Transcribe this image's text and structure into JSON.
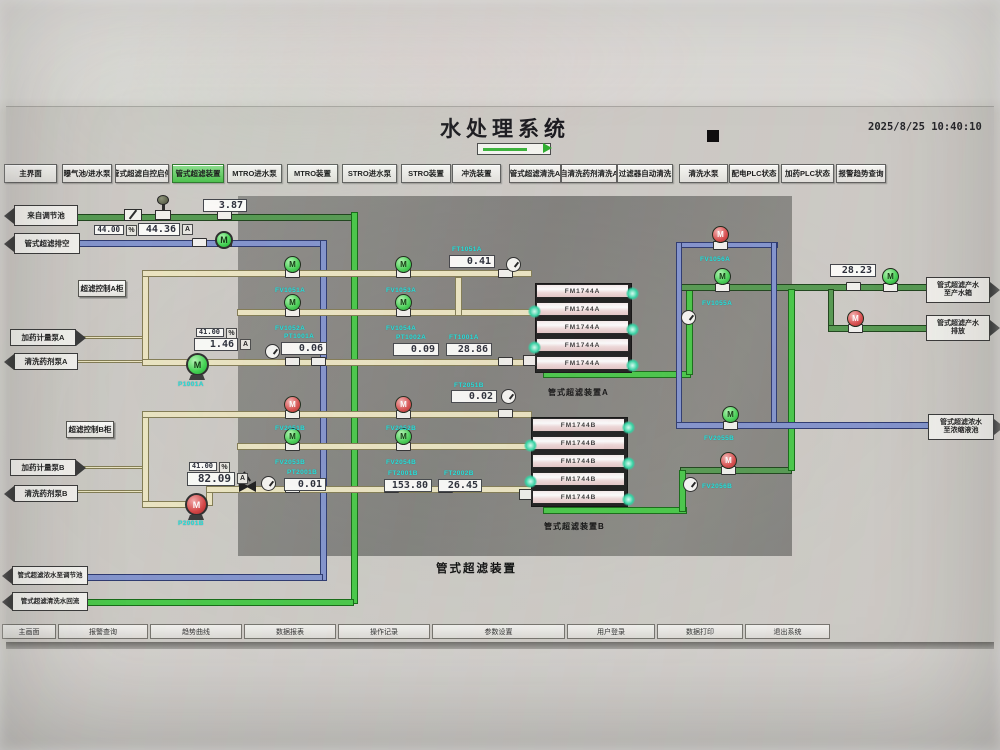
{
  "header": {
    "title": "水处理系统",
    "datetime": "2025/8/25  10:40:10"
  },
  "colors": {
    "active_tab": "#4cc24c",
    "pipe_green": "#569a52",
    "pipe_bright_green": "#49c849",
    "pipe_blue": "#8494cd",
    "pipe_yellow": "#ece5c2",
    "valve_open": "#46d054",
    "valve_closed": "#d94d4d",
    "instrument_tag": "#23e2dd"
  },
  "tabs": [
    {
      "label": "主界面",
      "x": 4,
      "w": 53,
      "active": false
    },
    {
      "label": "曝气池/进水泵",
      "x": 62,
      "w": 50,
      "active": false
    },
    {
      "label": "管式超滤自控启停",
      "x": 115,
      "w": 54,
      "active": false
    },
    {
      "label": "管式超滤装置",
      "x": 172,
      "w": 52,
      "active": true
    },
    {
      "label": "MTRO进水泵",
      "x": 227,
      "w": 55,
      "active": false
    },
    {
      "label": "MTRO装置",
      "x": 287,
      "w": 51,
      "active": false
    },
    {
      "label": "STRO进水泵",
      "x": 342,
      "w": 55,
      "active": false
    },
    {
      "label": "STRO装置",
      "x": 401,
      "w": 50,
      "active": false
    },
    {
      "label": "冲洗装置",
      "x": 452,
      "w": 49,
      "active": false
    },
    {
      "label": "管式超滤清洗A",
      "x": 509,
      "w": 52,
      "active": false
    },
    {
      "label": "自清洗药剂清洗A",
      "x": 561,
      "w": 56,
      "active": false
    },
    {
      "label": "过滤器自动清洗",
      "x": 617,
      "w": 56,
      "active": false
    },
    {
      "label": "清洗水泵",
      "x": 679,
      "w": 49,
      "active": false
    },
    {
      "label": "配电PLC状态",
      "x": 729,
      "w": 50,
      "active": false
    },
    {
      "label": "加药PLC状态",
      "x": 781,
      "w": 53,
      "active": false
    },
    {
      "label": "报警趋势查询",
      "x": 836,
      "w": 50,
      "active": false
    }
  ],
  "footer_buttons": [
    {
      "label": "主画面",
      "x": 0,
      "w": 54
    },
    {
      "label": "报警查询",
      "x": 56,
      "w": 90
    },
    {
      "label": "趋势曲线",
      "x": 148,
      "w": 92
    },
    {
      "label": "数据报表",
      "x": 242,
      "w": 92
    },
    {
      "label": "操作记录",
      "x": 336,
      "w": 92
    },
    {
      "label": "参数设置",
      "x": 430,
      "w": 133
    },
    {
      "label": "用户登录",
      "x": 565,
      "w": 88
    },
    {
      "label": "数据打印",
      "x": 655,
      "w": 86
    },
    {
      "label": "退出系统",
      "x": 743,
      "w": 85
    }
  ],
  "diagram": {
    "center_title": "管式超滤装置",
    "cabinets": [
      {
        "label": "超滤控制A柜",
        "x": 78,
        "y": 280,
        "w": 48,
        "h": 17
      },
      {
        "label": "超滤控制B柜",
        "x": 66,
        "y": 421,
        "w": 48,
        "h": 17
      }
    ],
    "pipes": [
      {
        "x": 77,
        "y": 214,
        "w": 276,
        "h": 7,
        "c": "green"
      },
      {
        "x": 351,
        "y": 212,
        "w": 7,
        "h": 392,
        "c": "bgreen"
      },
      {
        "x": 80,
        "y": 599,
        "w": 274,
        "h": 7,
        "c": "bgreen"
      },
      {
        "x": 543,
        "y": 371,
        "w": 148,
        "h": 7,
        "c": "bgreen"
      },
      {
        "x": 686,
        "y": 289,
        "w": 7,
        "h": 86,
        "c": "bgreen"
      },
      {
        "x": 679,
        "y": 284,
        "w": 260,
        "h": 7,
        "c": "green"
      },
      {
        "x": 828,
        "y": 289,
        "w": 6,
        "h": 40,
        "c": "green"
      },
      {
        "x": 828,
        "y": 325,
        "w": 110,
        "h": 7,
        "c": "green"
      },
      {
        "x": 680,
        "y": 467,
        "w": 112,
        "h": 7,
        "c": "green"
      },
      {
        "x": 788,
        "y": 289,
        "w": 7,
        "h": 182,
        "c": "bgreen"
      },
      {
        "x": 543,
        "y": 507,
        "w": 144,
        "h": 7,
        "c": "bgreen"
      },
      {
        "x": 679,
        "y": 470,
        "w": 7,
        "h": 42,
        "c": "bgreen"
      },
      {
        "x": 77,
        "y": 240,
        "w": 250,
        "h": 7,
        "c": "blue"
      },
      {
        "x": 320,
        "y": 240,
        "w": 7,
        "h": 341,
        "c": "blue"
      },
      {
        "x": 85,
        "y": 574,
        "w": 238,
        "h": 7,
        "c": "blue"
      },
      {
        "x": 679,
        "y": 242,
        "w": 99,
        "h": 6,
        "c": "blue"
      },
      {
        "x": 676,
        "y": 242,
        "w": 6,
        "h": 186,
        "c": "blue"
      },
      {
        "x": 771,
        "y": 242,
        "w": 6,
        "h": 186,
        "c": "blue"
      },
      {
        "x": 676,
        "y": 422,
        "w": 262,
        "h": 7,
        "c": "blue"
      },
      {
        "x": 142,
        "y": 270,
        "w": 7,
        "h": 95,
        "c": "yellow"
      },
      {
        "x": 142,
        "y": 270,
        "w": 390,
        "h": 7,
        "c": "yellow"
      },
      {
        "x": 237,
        "y": 309,
        "w": 295,
        "h": 7,
        "c": "yellow"
      },
      {
        "x": 142,
        "y": 359,
        "w": 390,
        "h": 7,
        "c": "yellow"
      },
      {
        "x": 77,
        "y": 336,
        "w": 66,
        "h": 3,
        "c": "yellow"
      },
      {
        "x": 77,
        "y": 360,
        "w": 66,
        "h": 3,
        "c": "yellow"
      },
      {
        "x": 455,
        "y": 277,
        "w": 7,
        "h": 39,
        "c": "yellow"
      },
      {
        "x": 142,
        "y": 411,
        "w": 7,
        "h": 95,
        "c": "yellow"
      },
      {
        "x": 142,
        "y": 411,
        "w": 390,
        "h": 7,
        "c": "yellow"
      },
      {
        "x": 237,
        "y": 443,
        "w": 295,
        "h": 7,
        "c": "yellow"
      },
      {
        "x": 142,
        "y": 501,
        "w": 60,
        "h": 7,
        "c": "yellow"
      },
      {
        "x": 206,
        "y": 486,
        "w": 7,
        "h": 20,
        "c": "yellow"
      },
      {
        "x": 206,
        "y": 486,
        "w": 326,
        "h": 7,
        "c": "yellow"
      },
      {
        "x": 77,
        "y": 466,
        "w": 66,
        "h": 3,
        "c": "yellow"
      },
      {
        "x": 77,
        "y": 490,
        "w": 66,
        "h": 3,
        "c": "yellow"
      }
    ],
    "valves": [
      {
        "x": 284,
        "y": 256,
        "s": "o",
        "py": 270,
        "name": "valve-FV1051A"
      },
      {
        "x": 395,
        "y": 256,
        "s": "o",
        "py": 270,
        "name": "valve-FV1053A"
      },
      {
        "x": 284,
        "y": 294,
        "s": "o",
        "py": 309,
        "name": "valve-FV1052A"
      },
      {
        "x": 395,
        "y": 294,
        "s": "o",
        "py": 309,
        "name": "valve-FV1054A"
      },
      {
        "x": 284,
        "y": 396,
        "s": "c",
        "py": 411,
        "name": "valve-FV2051B"
      },
      {
        "x": 395,
        "y": 396,
        "s": "c",
        "py": 411,
        "name": "valve-FV2052B"
      },
      {
        "x": 284,
        "y": 428,
        "s": "o",
        "py": 443,
        "name": "valve-FV2053B"
      },
      {
        "x": 395,
        "y": 428,
        "s": "o",
        "py": 443,
        "name": "valve-FV2054B"
      },
      {
        "x": 714,
        "y": 268,
        "s": "o",
        "py": 284,
        "name": "valve-FV1055A"
      },
      {
        "x": 882,
        "y": 268,
        "s": "o",
        "py": 284,
        "name": "valve-product-outlet"
      },
      {
        "x": 712,
        "y": 226,
        "s": "c",
        "py": 242,
        "name": "valve-FV1056A"
      },
      {
        "x": 847,
        "y": 310,
        "s": "c",
        "py": 325,
        "name": "valve-drain-outlet"
      },
      {
        "x": 722,
        "y": 406,
        "s": "o",
        "py": 422,
        "name": "valve-FV2055B"
      },
      {
        "x": 720,
        "y": 452,
        "s": "c",
        "py": 467,
        "name": "valve-FV2056B"
      }
    ],
    "fittings": [
      {
        "x": 498,
        "y": 269
      },
      {
        "x": 285,
        "y": 357
      },
      {
        "x": 311,
        "y": 357
      },
      {
        "x": 498,
        "y": 357
      },
      {
        "x": 498,
        "y": 409
      },
      {
        "x": 285,
        "y": 484
      },
      {
        "x": 384,
        "y": 484
      },
      {
        "x": 438,
        "y": 484
      },
      {
        "x": 846,
        "y": 282
      },
      {
        "x": 192,
        "y": 238
      },
      {
        "x": 217,
        "y": 238
      },
      {
        "x": 217,
        "y": 211
      }
    ],
    "gauges": [
      {
        "x": 506,
        "y": 257
      },
      {
        "x": 265,
        "y": 344
      },
      {
        "x": 501,
        "y": 389
      },
      {
        "x": 261,
        "y": 476
      },
      {
        "x": 681,
        "y": 310
      },
      {
        "x": 683,
        "y": 477
      }
    ],
    "pumps": [
      {
        "x": 215,
        "y": 231,
        "size": 18,
        "s": "run",
        "feet": false,
        "label": "M",
        "name": "pump-feed-booster"
      },
      {
        "x": 186,
        "y": 353,
        "size": 23,
        "s": "run",
        "feet": true,
        "label": "M",
        "name": "pump-P1001A"
      },
      {
        "x": 185,
        "y": 493,
        "size": 23,
        "s": "stop",
        "feet": true,
        "label": "M",
        "name": "pump-P2001B"
      }
    ],
    "values": [
      {
        "x": 203,
        "y": 199,
        "w": 44,
        "h": 13,
        "t": "3.87",
        "fs": 10
      },
      {
        "x": 94,
        "y": 225,
        "w": 30,
        "h": 10,
        "t": "44.00",
        "fs": 7.5
      },
      {
        "x": 138,
        "y": 223,
        "w": 42,
        "h": 13,
        "t": "44.36",
        "fs": 10
      },
      {
        "x": 449,
        "y": 255,
        "w": 46,
        "h": 13,
        "t": "0.41",
        "fs": 10
      },
      {
        "x": 281,
        "y": 342,
        "w": 46,
        "h": 13,
        "t": "0.06",
        "fs": 10
      },
      {
        "x": 393,
        "y": 343,
        "w": 46,
        "h": 13,
        "t": "0.09",
        "fs": 10
      },
      {
        "x": 446,
        "y": 343,
        "w": 46,
        "h": 13,
        "t": "28.86",
        "fs": 10
      },
      {
        "x": 830,
        "y": 264,
        "w": 46,
        "h": 13,
        "t": "28.23",
        "fs": 10
      },
      {
        "x": 451,
        "y": 390,
        "w": 46,
        "h": 13,
        "t": "0.02",
        "fs": 10
      },
      {
        "x": 196,
        "y": 328,
        "w": 28,
        "h": 9,
        "t": "41.00",
        "fs": 7
      },
      {
        "x": 194,
        "y": 338,
        "w": 44,
        "h": 13,
        "t": "1.46",
        "fs": 10
      },
      {
        "x": 189,
        "y": 462,
        "w": 28,
        "h": 9,
        "t": "41.00",
        "fs": 7
      },
      {
        "x": 187,
        "y": 472,
        "w": 48,
        "h": 14,
        "t": "82.09",
        "fs": 11
      },
      {
        "x": 284,
        "y": 478,
        "w": 42,
        "h": 13,
        "t": "0.01",
        "fs": 10
      },
      {
        "x": 384,
        "y": 479,
        "w": 48,
        "h": 13,
        "t": "153.80",
        "fs": 10
      },
      {
        "x": 438,
        "y": 479,
        "w": 44,
        "h": 13,
        "t": "26.45",
        "fs": 10
      }
    ],
    "units": [
      {
        "x": 126,
        "y": 225,
        "t": "%"
      },
      {
        "x": 182,
        "y": 224,
        "t": "A"
      },
      {
        "x": 226,
        "y": 328,
        "t": "%"
      },
      {
        "x": 240,
        "y": 339,
        "t": "A"
      },
      {
        "x": 219,
        "y": 462,
        "t": "%"
      },
      {
        "x": 237,
        "y": 473,
        "t": "A"
      }
    ],
    "tags": [
      {
        "x": 452,
        "y": 246,
        "t": "FT1051A"
      },
      {
        "x": 284,
        "y": 333,
        "t": "PT1001A"
      },
      {
        "x": 396,
        "y": 334,
        "t": "PT1002A"
      },
      {
        "x": 449,
        "y": 334,
        "t": "FT1001A"
      },
      {
        "x": 454,
        "y": 382,
        "t": "FT2051B"
      },
      {
        "x": 287,
        "y": 469,
        "t": "PT2001B"
      },
      {
        "x": 388,
        "y": 470,
        "t": "FT2001B"
      },
      {
        "x": 444,
        "y": 470,
        "t": "FT2002B"
      },
      {
        "x": 275,
        "y": 287,
        "t": "FV1051A"
      },
      {
        "x": 386,
        "y": 287,
        "t": "FV1053A"
      },
      {
        "x": 275,
        "y": 325,
        "t": "FV1052A"
      },
      {
        "x": 386,
        "y": 325,
        "t": "FV1054A"
      },
      {
        "x": 275,
        "y": 425,
        "t": "FV2051B"
      },
      {
        "x": 386,
        "y": 425,
        "t": "FV2052B"
      },
      {
        "x": 275,
        "y": 459,
        "t": "FV2053B"
      },
      {
        "x": 386,
        "y": 459,
        "t": "FV2054B"
      },
      {
        "x": 700,
        "y": 256,
        "t": "FV1056A"
      },
      {
        "x": 702,
        "y": 300,
        "t": "FV1055A"
      },
      {
        "x": 704,
        "y": 435,
        "t": "FV2055B"
      },
      {
        "x": 702,
        "y": 483,
        "t": "FV2056B"
      },
      {
        "x": 178,
        "y": 381,
        "t": "P1001A"
      },
      {
        "x": 178,
        "y": 520,
        "t": "P2001B"
      }
    ],
    "banks": [
      {
        "x": 535,
        "y": 283,
        "w": 95,
        "h": 88,
        "modules": [
          "FM1744A",
          "FM1744A",
          "FM1744A",
          "FM1744A",
          "FM1744A"
        ],
        "dots": [
          {
            "x": 626,
            "y": 287
          },
          {
            "x": 626,
            "y": 323
          },
          {
            "x": 626,
            "y": 359
          },
          {
            "x": 528,
            "y": 305
          },
          {
            "x": 528,
            "y": 341
          }
        ],
        "cap": {
          "x": 523,
          "y": 355
        },
        "caption": {
          "x": 548,
          "y": 387,
          "t": "管式超滤装置A"
        }
      },
      {
        "x": 531,
        "y": 417,
        "w": 95,
        "h": 88,
        "modules": [
          "FM1744B",
          "FM1744B",
          "FM1744B",
          "FM1744B",
          "FM1744B"
        ],
        "dots": [
          {
            "x": 622,
            "y": 421
          },
          {
            "x": 622,
            "y": 457
          },
          {
            "x": 622,
            "y": 493
          },
          {
            "x": 524,
            "y": 439
          },
          {
            "x": 524,
            "y": 475
          }
        ],
        "cap": {
          "x": 519,
          "y": 489
        },
        "caption": {
          "x": 544,
          "y": 521,
          "t": "管式超滤装置B"
        }
      }
    ],
    "arrows": [
      {
        "x": 14,
        "y": 205,
        "w": 64,
        "h": 21,
        "dir": "left",
        "lines": [
          "来自调节池"
        ],
        "fs": 7.5
      },
      {
        "x": 14,
        "y": 233,
        "w": 66,
        "h": 21,
        "dir": "left",
        "lines": [
          "管式超滤排空"
        ],
        "fs": 7.5
      },
      {
        "x": 10,
        "y": 329,
        "w": 66,
        "h": 17,
        "dir": "right",
        "lines": [
          "加药计量泵A"
        ],
        "fs": 7.5
      },
      {
        "x": 14,
        "y": 353,
        "w": 64,
        "h": 17,
        "dir": "left",
        "lines": [
          "清洗药剂泵A"
        ],
        "fs": 7.5
      },
      {
        "x": 10,
        "y": 459,
        "w": 66,
        "h": 17,
        "dir": "right",
        "lines": [
          "加药计量泵B"
        ],
        "fs": 7.5
      },
      {
        "x": 14,
        "y": 485,
        "w": 64,
        "h": 17,
        "dir": "left",
        "lines": [
          "清洗药剂泵B"
        ],
        "fs": 7.5
      },
      {
        "x": 926,
        "y": 277,
        "w": 64,
        "h": 26,
        "dir": "right",
        "lines": [
          "管式超滤产水",
          "至产水箱"
        ],
        "fs": 7
      },
      {
        "x": 926,
        "y": 315,
        "w": 64,
        "h": 26,
        "dir": "right",
        "lines": [
          "管式超滤产水",
          "排放"
        ],
        "fs": 7
      },
      {
        "x": 928,
        "y": 414,
        "w": 66,
        "h": 26,
        "dir": "right",
        "lines": [
          "管式超滤浓水",
          "至浓缩液池"
        ],
        "fs": 7
      },
      {
        "x": 12,
        "y": 566,
        "w": 76,
        "h": 19,
        "dir": "left",
        "lines": [
          "管式超滤浓水至调节池"
        ],
        "fs": 6.5
      },
      {
        "x": 12,
        "y": 592,
        "w": 76,
        "h": 19,
        "dir": "left",
        "lines": [
          "管式超滤清洗水回流"
        ],
        "fs": 6.5
      }
    ]
  }
}
